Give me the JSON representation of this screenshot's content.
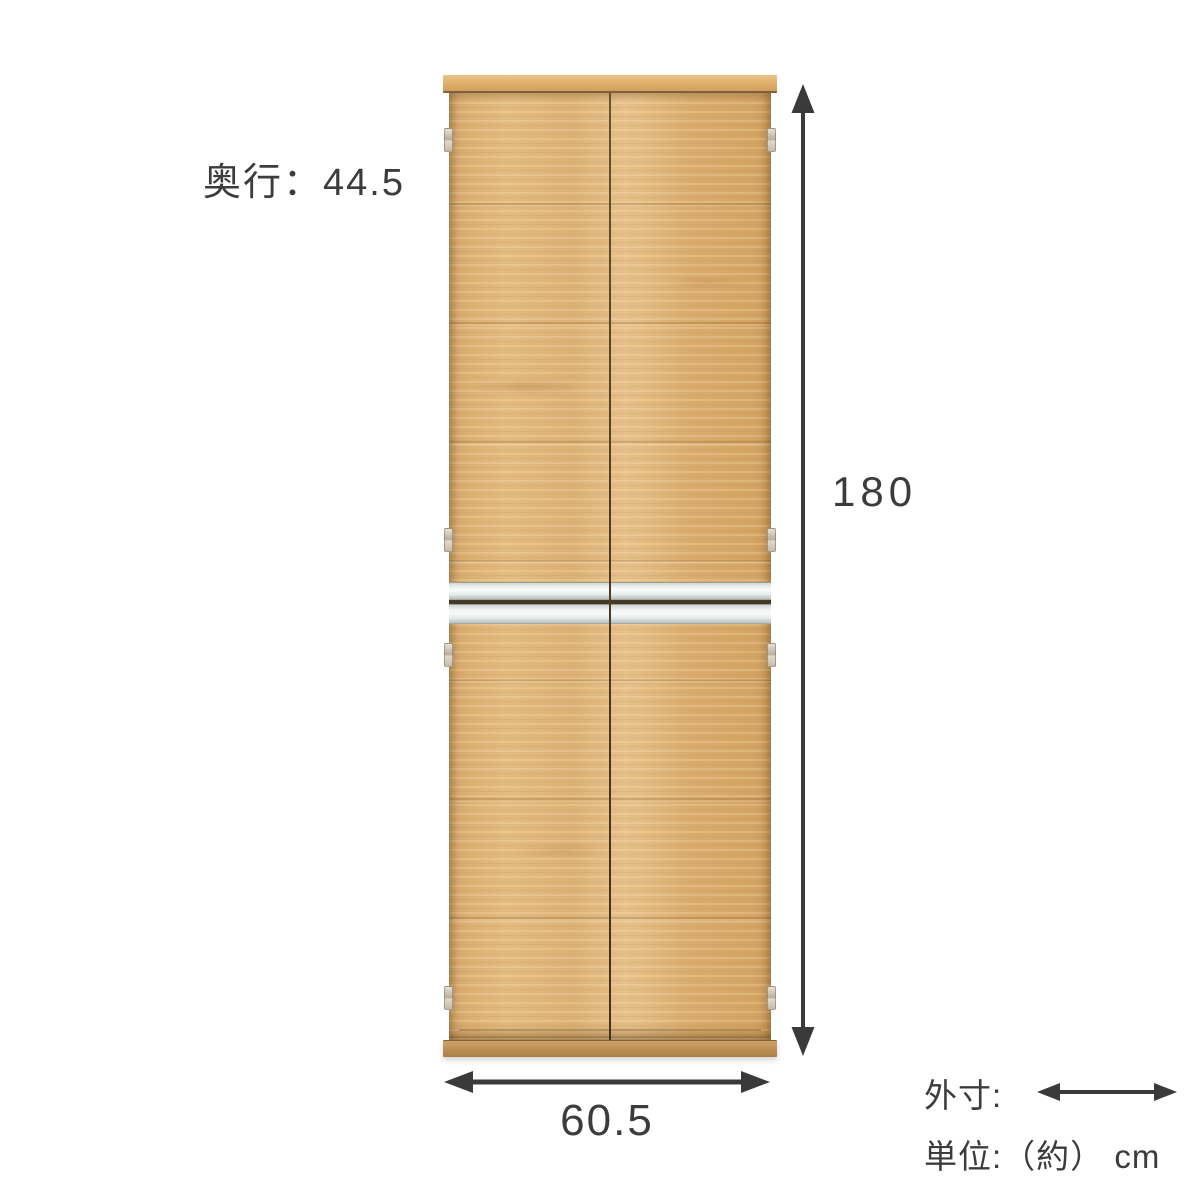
{
  "annotations": {
    "depth_label": "奥行：44.5",
    "height_value": "180",
    "width_value": "60.5"
  },
  "legend": {
    "outer_dimension_label": "外寸:",
    "unit_label": "単位:（約） cm"
  },
  "product": {
    "description": "tall wooden storage cabinet with four doors, vertical center gap, two silver horizontal handle strips and side hinges"
  },
  "icons": {
    "vertical_dimension_arrow": "double-headed-arrow-vertical",
    "horizontal_dimension_arrow": "double-headed-arrow-horizontal",
    "legend_dimension_arrow": "double-headed-arrow-horizontal"
  },
  "colors": {
    "background": "#ffffff",
    "annotation_text": "#3c3c3c",
    "dimension_arrow": "#3a3a3a",
    "wood_light": "#e6c089",
    "wood_base": "#dcb175",
    "wood_dark": "#c5954f",
    "top_board": "#dfae6a",
    "door_gap": "#473826",
    "handle_silver": "#eef2f1",
    "hinge_metal": "#c4bbaa"
  }
}
